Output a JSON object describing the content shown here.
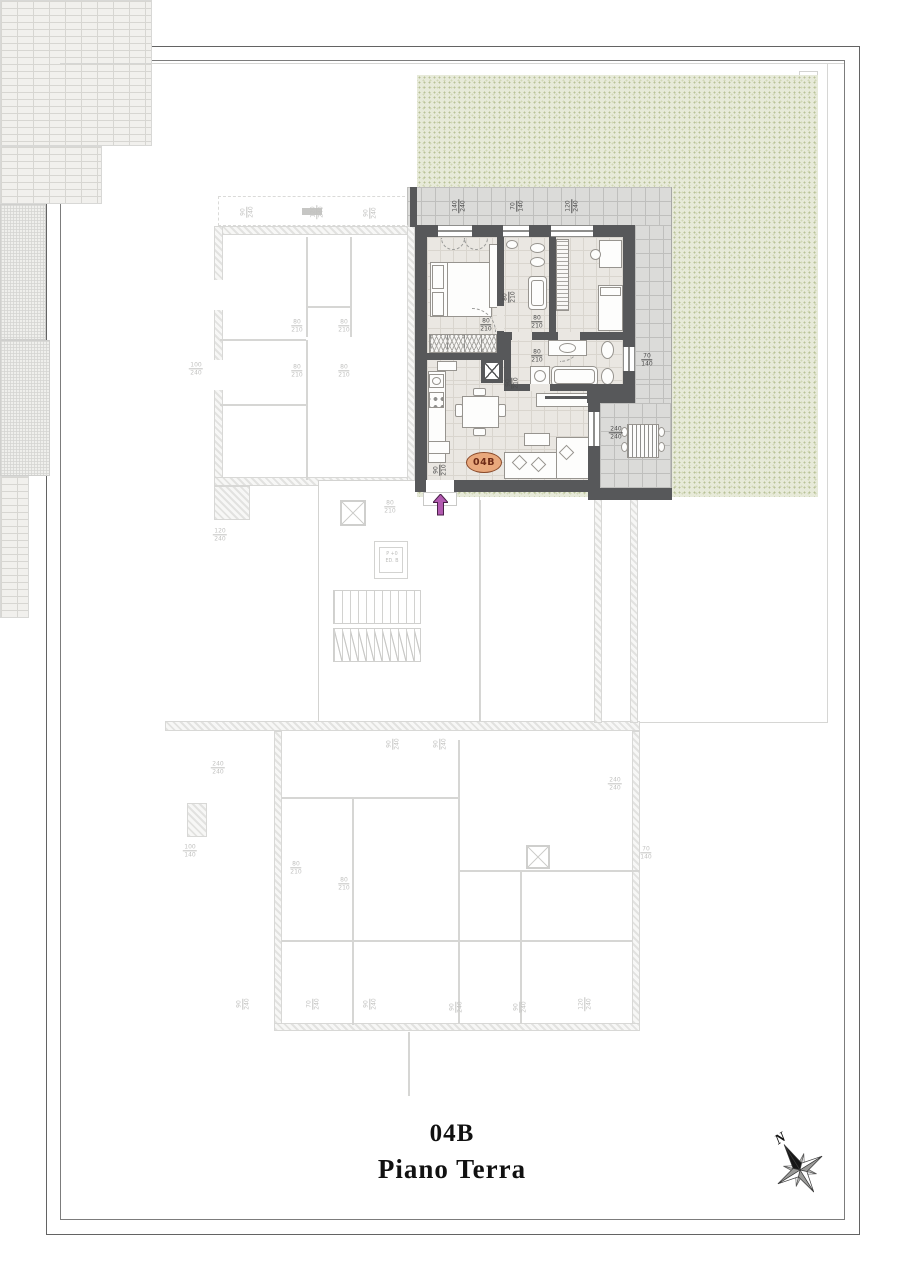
{
  "title": {
    "unit": "04B",
    "floor": "Piano Terra"
  },
  "badge": {
    "label": "04B"
  },
  "compass": {
    "n": "N"
  },
  "elevator": {
    "line1": "P +0",
    "line2": "ED. B"
  },
  "colors": {
    "wall": "#57585a",
    "terrace_tile": "#dbdbd9",
    "floor": "#eae7e2",
    "garden": "#e7ead9",
    "faint": "#d6d6d4",
    "badge_fill": "#e9a87c",
    "badge_border": "#8a4a2a",
    "badge_text": "#6e2a16",
    "arrow": "#b25ab0"
  },
  "dim_labels": [
    {
      "a": "140",
      "b": "240",
      "x": 459,
      "y": 206,
      "v": 1,
      "f": 0
    },
    {
      "a": "70",
      "b": "140",
      "x": 517,
      "y": 206,
      "v": 1,
      "f": 0
    },
    {
      "a": "120",
      "b": "240",
      "x": 572,
      "y": 206,
      "v": 1,
      "f": 0
    },
    {
      "a": "80",
      "b": "210",
      "x": 509,
      "y": 297,
      "v": 1,
      "f": 0
    },
    {
      "a": "80",
      "b": "210",
      "x": 486,
      "y": 325,
      "v": 0,
      "f": 0
    },
    {
      "a": "80",
      "b": "210",
      "x": 537,
      "y": 322,
      "v": 0,
      "f": 0
    },
    {
      "a": "80",
      "b": "210",
      "x": 537,
      "y": 356,
      "v": 0,
      "f": 0
    },
    {
      "a": "90",
      "b": "210",
      "x": 512,
      "y": 383,
      "v": 1,
      "f": 0
    },
    {
      "a": "70",
      "b": "140",
      "x": 647,
      "y": 360,
      "v": 0,
      "f": 0
    },
    {
      "a": "240",
      "b": "240",
      "x": 616,
      "y": 433,
      "v": 0,
      "f": 0
    },
    {
      "a": "90",
      "b": "210",
      "x": 440,
      "y": 470,
      "v": 1,
      "f": 0
    },
    {
      "a": "90",
      "b": "240",
      "x": 247,
      "y": 212,
      "v": 1,
      "f": 1
    },
    {
      "a": "120",
      "b": "240",
      "x": 317,
      "y": 212,
      "v": 1,
      "f": 1
    },
    {
      "a": "90",
      "b": "240",
      "x": 370,
      "y": 213,
      "v": 1,
      "f": 1
    },
    {
      "a": "80",
      "b": "210",
      "x": 297,
      "y": 326,
      "v": 0,
      "f": 1
    },
    {
      "a": "80",
      "b": "210",
      "x": 344,
      "y": 326,
      "v": 0,
      "f": 1
    },
    {
      "a": "80",
      "b": "210",
      "x": 297,
      "y": 371,
      "v": 0,
      "f": 1
    },
    {
      "a": "80",
      "b": "210",
      "x": 344,
      "y": 371,
      "v": 0,
      "f": 1
    },
    {
      "a": "100",
      "b": "240",
      "x": 196,
      "y": 369,
      "v": 0,
      "f": 1
    },
    {
      "a": "80",
      "b": "210",
      "x": 390,
      "y": 507,
      "v": 0,
      "f": 1
    },
    {
      "a": "120",
      "b": "240",
      "x": 220,
      "y": 535,
      "v": 0,
      "f": 1
    },
    {
      "a": "240",
      "b": "240",
      "x": 218,
      "y": 768,
      "v": 0,
      "f": 1
    },
    {
      "a": "100",
      "b": "140",
      "x": 190,
      "y": 851,
      "v": 0,
      "f": 1
    },
    {
      "a": "80",
      "b": "210",
      "x": 296,
      "y": 868,
      "v": 0,
      "f": 1
    },
    {
      "a": "80",
      "b": "210",
      "x": 344,
      "y": 884,
      "v": 0,
      "f": 1
    },
    {
      "a": "90",
      "b": "240",
      "x": 393,
      "y": 744,
      "v": 1,
      "f": 1
    },
    {
      "a": "90",
      "b": "240",
      "x": 440,
      "y": 744,
      "v": 1,
      "f": 1
    },
    {
      "a": "240",
      "b": "240",
      "x": 615,
      "y": 784,
      "v": 0,
      "f": 1
    },
    {
      "a": "70",
      "b": "140",
      "x": 646,
      "y": 853,
      "v": 0,
      "f": 1
    },
    {
      "a": "90",
      "b": "240",
      "x": 243,
      "y": 1004,
      "v": 1,
      "f": 1
    },
    {
      "a": "70",
      "b": "240",
      "x": 313,
      "y": 1004,
      "v": 1,
      "f": 1
    },
    {
      "a": "90",
      "b": "240",
      "x": 370,
      "y": 1004,
      "v": 1,
      "f": 1
    },
    {
      "a": "90",
      "b": "240",
      "x": 456,
      "y": 1007,
      "v": 1,
      "f": 1
    },
    {
      "a": "90",
      "b": "240",
      "x": 520,
      "y": 1007,
      "v": 1,
      "f": 1
    },
    {
      "a": "120",
      "b": "240",
      "x": 585,
      "y": 1004,
      "v": 1,
      "f": 1
    }
  ]
}
